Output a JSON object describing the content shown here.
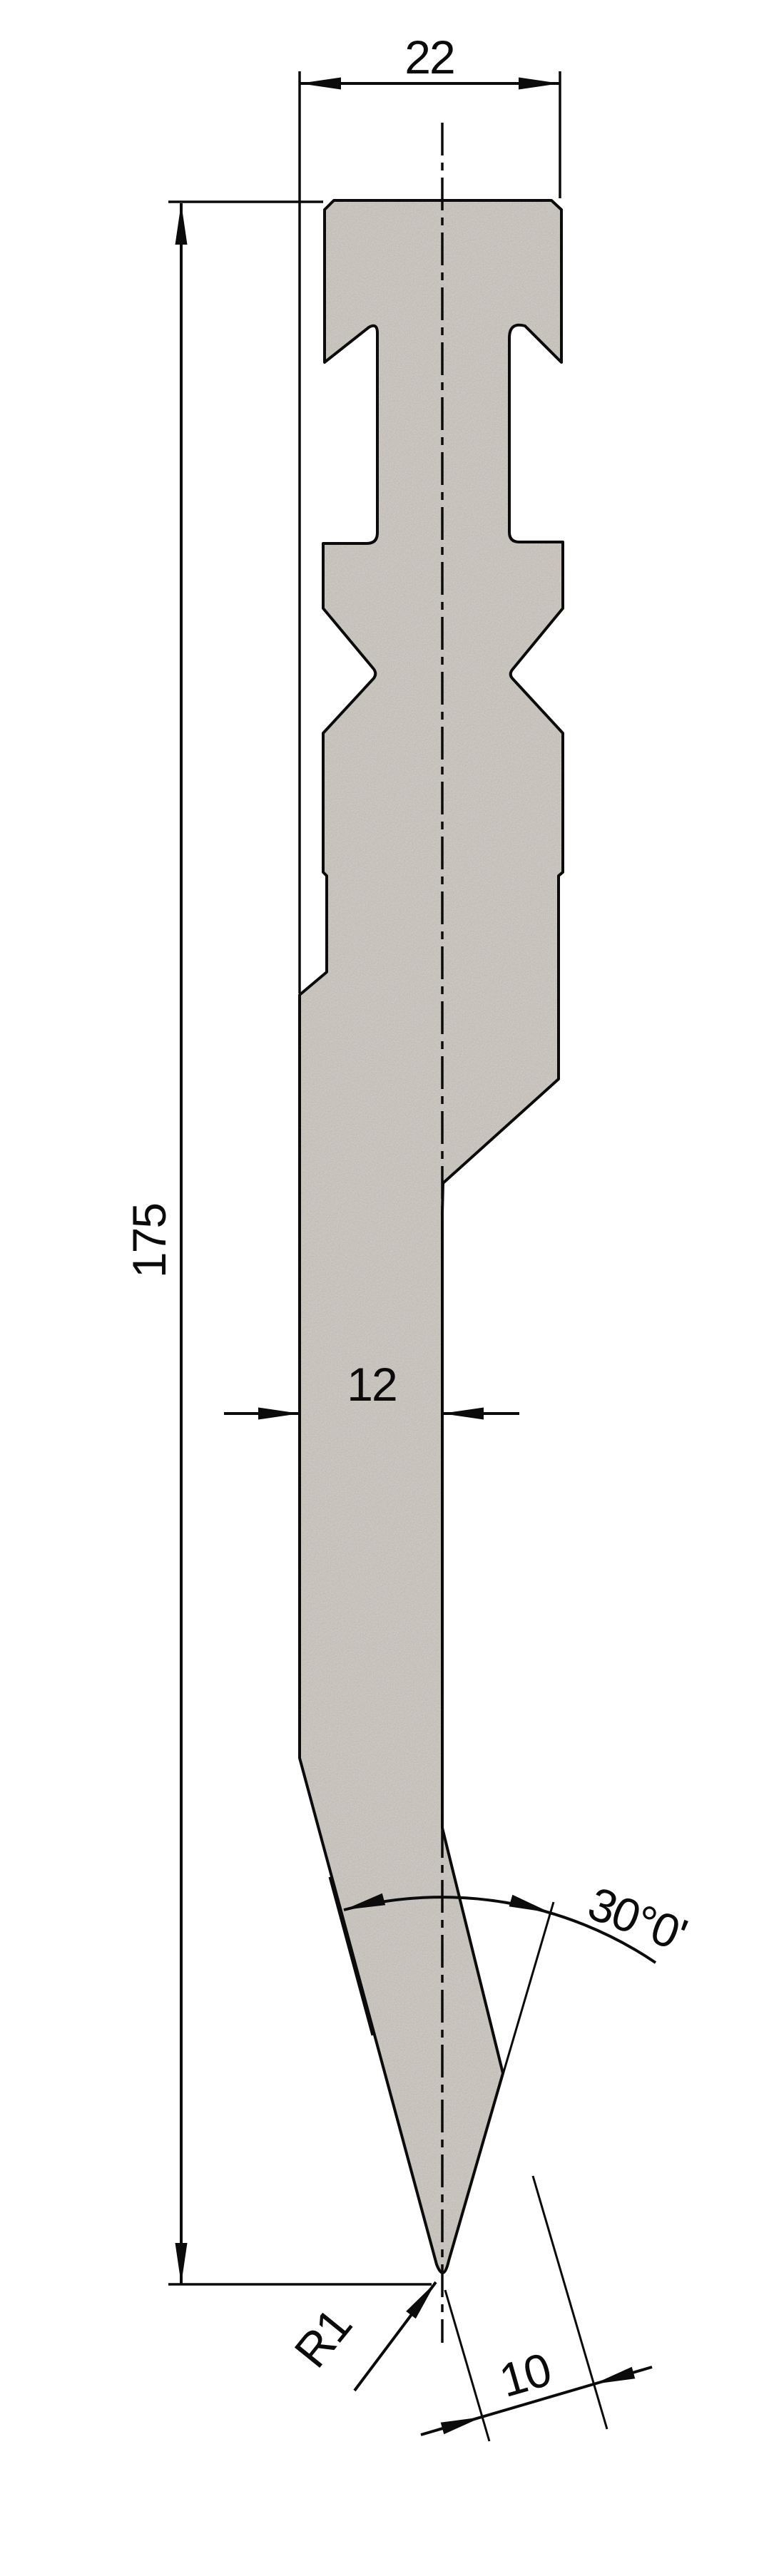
{
  "drawing": {
    "title": "press-brake-punch-technical-drawing",
    "dimensions": {
      "top_width": "22",
      "overall_height": "175",
      "blade_width": "12",
      "tip_angle": "30°0'",
      "tip_radius": "R1",
      "tip_offset": "10"
    },
    "colors": {
      "part_fill": "#d6d2cc",
      "grain": "#6f6a62",
      "line": "#0b0b0b",
      "background": "#ffffff"
    }
  }
}
